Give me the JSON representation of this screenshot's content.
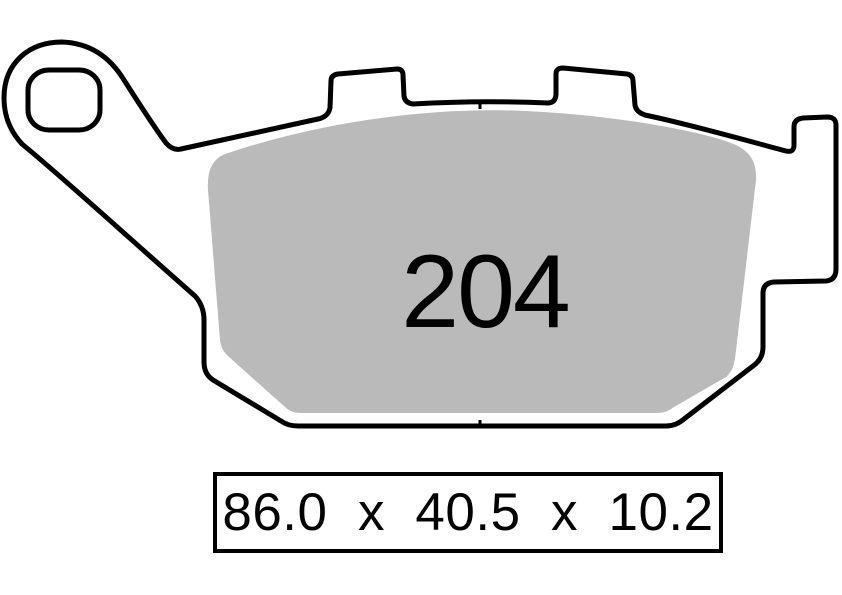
{
  "diagram": {
    "compound_number": "204",
    "colors": {
      "outline": "#000000",
      "friction_material": "#bababa",
      "backplate_fill": "#ffffff"
    }
  },
  "dimensions_box": {
    "text": "86.0  x  40.5  x  10.2",
    "parts": [
      "86.0",
      "40.5",
      "10.2"
    ],
    "separator": "x"
  }
}
